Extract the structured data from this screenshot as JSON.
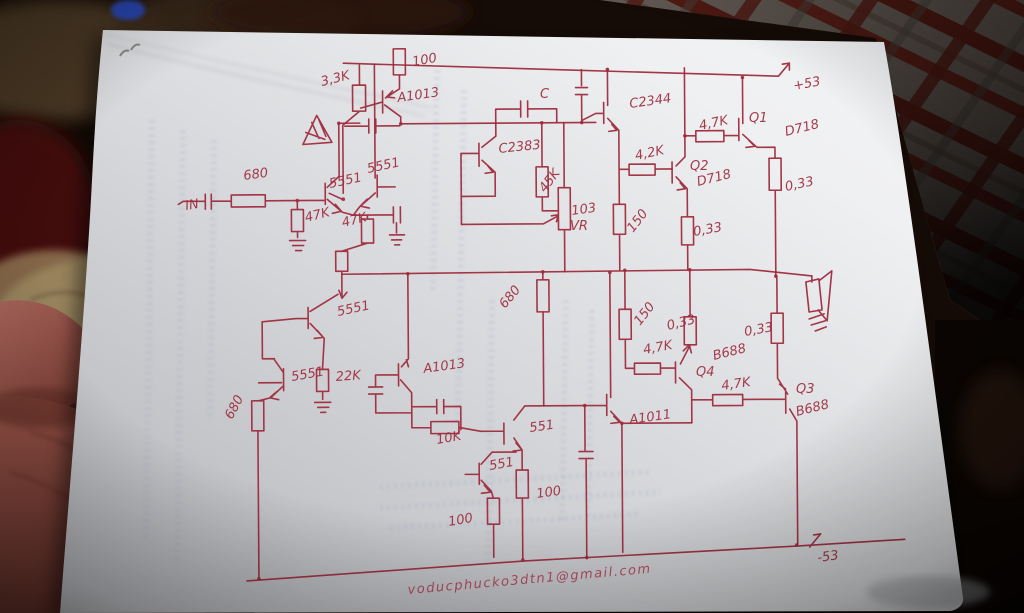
{
  "colors": {
    "ink": "#9e2b3d",
    "paper": "#e3e4e7",
    "blanket": "#140b07",
    "lattice-red": "#6f241b",
    "skin": "#8d4b40",
    "blue-object": "#2646b8"
  },
  "schematic": {
    "supply_positive": "+53",
    "supply_negative": "-53",
    "input_label": "IN",
    "signature_email": "voducphucko3dtn1@gmail.com",
    "component_labels": [
      "3,3K",
      "100",
      "A1013",
      "C",
      "C2383",
      "C2344",
      "4,7K",
      "Q1",
      "D718",
      "4,2K",
      "Q2",
      "D718",
      "0,33",
      "45K",
      "103",
      "VR",
      "150",
      "0,33",
      "680",
      "47K",
      "5551",
      "5551",
      "47K",
      "680",
      "150",
      "0,33",
      "4,7K",
      "Q4",
      "B688",
      "0,33",
      "4,7K",
      "Q3",
      "B688",
      "A1011",
      "5551",
      "5551",
      "22K",
      "680",
      "A1013",
      "10K",
      "551",
      "551",
      "100",
      "100"
    ]
  }
}
